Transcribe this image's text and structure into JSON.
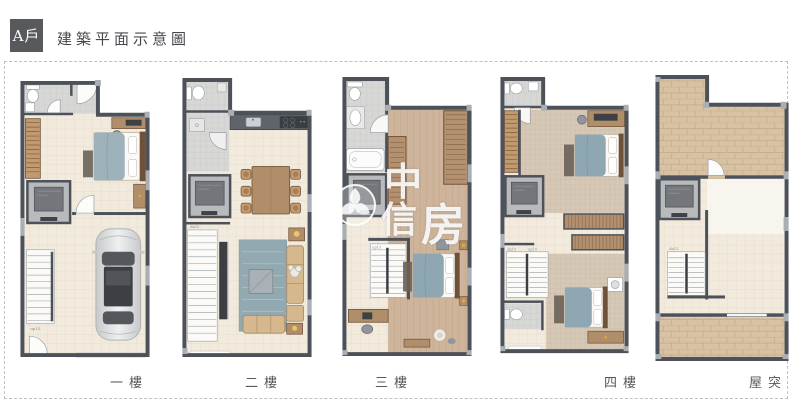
{
  "header": {
    "unit_label": "A戶",
    "title": "建築平面示意圖"
  },
  "floors": [
    {
      "id": "1f",
      "label": "一樓"
    },
    {
      "id": "2f",
      "label": "二樓"
    },
    {
      "id": "3f",
      "label": "三樓"
    },
    {
      "id": "4f",
      "label": "四樓"
    },
    {
      "id": "rf",
      "label": "屋突"
    }
  ],
  "watermark": {
    "chars": [
      "中",
      "信",
      "房"
    ]
  },
  "stair_labels": {
    "up": "up15",
    "dn": "dn15"
  },
  "colors": {
    "wall": "#4d525a",
    "floor_tile": "#f1eadd",
    "bath_tile": "#d7d7d5",
    "wood": "#b08e6a",
    "wood_floor": "#cdb49a",
    "terrace_brick": "#d8c2a4",
    "sofa": "#d6b88f",
    "bed_blanket": "#8fa7b2",
    "badge_bg": "#57595c"
  }
}
